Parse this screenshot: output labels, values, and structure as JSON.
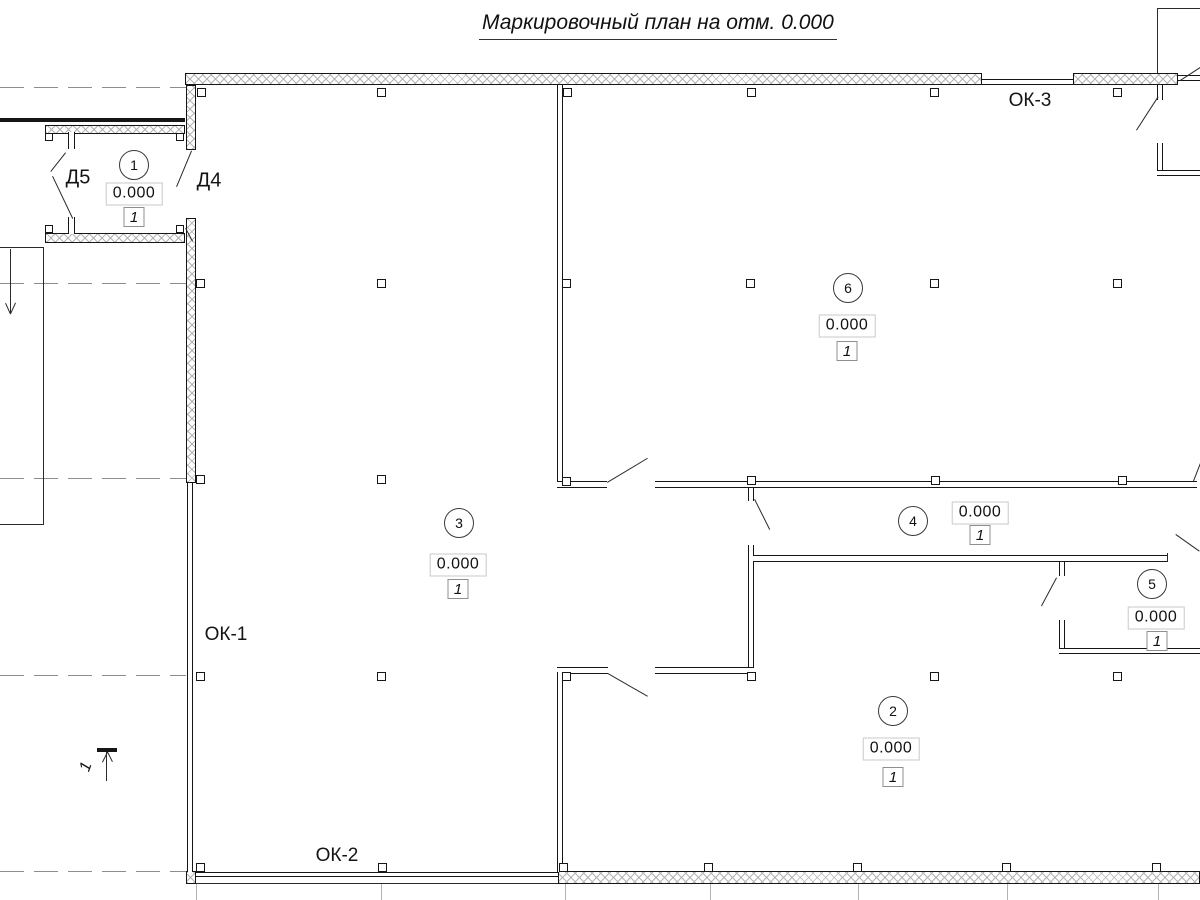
{
  "title": "Маркировочный план на отм. 0.000",
  "labels": {
    "ok1": {
      "text": "ОК-1"
    },
    "ok2": {
      "text": "ОК-2"
    },
    "ok3": {
      "text": "ОК-3"
    },
    "d5": {
      "text": "Д5"
    },
    "d4": {
      "text": "Д4"
    },
    "section": {
      "text": "1"
    }
  },
  "rooms": [
    {
      "number": "1",
      "elevation": "0.000",
      "finish": "1",
      "circle": [
        134,
        165
      ],
      "elev_pos": [
        134,
        194
      ],
      "fin_pos": [
        134,
        217
      ]
    },
    {
      "number": "6",
      "elevation": "0.000",
      "finish": "1",
      "circle": [
        848,
        288
      ],
      "elev_pos": [
        847,
        326
      ],
      "fin_pos": [
        847,
        351
      ]
    },
    {
      "number": "3",
      "elevation": "0.000",
      "finish": "1",
      "circle": [
        459,
        523
      ],
      "elev_pos": [
        458,
        565
      ],
      "fin_pos": [
        458,
        589
      ]
    },
    {
      "number": "4",
      "elevation": "0.000",
      "finish": "1",
      "circle": [
        913,
        521
      ],
      "elev_pos": [
        980,
        513
      ],
      "fin_pos": [
        980,
        535
      ]
    },
    {
      "number": "5",
      "elevation": "0.000",
      "finish": "1",
      "circle": [
        1152,
        584
      ],
      "elev_pos": [
        1156,
        618
      ],
      "fin_pos": [
        1157,
        641
      ]
    },
    {
      "number": "2",
      "elevation": "0.000",
      "finish": "1",
      "circle": [
        893,
        711
      ],
      "elev_pos": [
        891,
        749
      ],
      "fin_pos": [
        893,
        777
      ]
    }
  ],
  "colors": {
    "line": "#161616",
    "hatch": "#b4b4b4",
    "grid_dash": "#8d8d8d",
    "grid_light": "#b3b3b3",
    "elev_box_border": "#c9c9c9",
    "fin_box_border": "#8f8f8f"
  },
  "drawing": {
    "hatched_walls": [
      [
        185,
        73,
        797,
        12
      ],
      [
        1073,
        73,
        105,
        12
      ],
      [
        186,
        85,
        10,
        65
      ],
      [
        186,
        218,
        10,
        265
      ],
      [
        45,
        125,
        140,
        9
      ],
      [
        45,
        233,
        140,
        10
      ],
      [
        558,
        871,
        642,
        13
      ],
      [
        186,
        871,
        10,
        13
      ]
    ],
    "double_walls": [
      [
        557,
        85,
        6,
        397
      ],
      [
        557,
        481,
        50,
        7
      ],
      [
        655,
        481,
        542,
        7
      ],
      [
        748,
        545,
        6,
        128
      ],
      [
        753,
        555,
        415,
        7
      ],
      [
        655,
        667,
        99,
        7
      ],
      [
        557,
        667,
        51,
        7
      ],
      [
        557,
        672,
        6,
        200
      ],
      [
        1059,
        620,
        6,
        34
      ],
      [
        1059,
        648,
        141,
        6
      ],
      [
        1157,
        143,
        6,
        33
      ],
      [
        1157,
        170,
        43,
        6
      ],
      [
        187,
        483,
        6,
        389
      ],
      [
        982,
        79,
        91,
        6
      ],
      [
        1178,
        75,
        22,
        6
      ],
      [
        196,
        872,
        362,
        5
      ]
    ],
    "jamb_stubs": [
      [
        68,
        132,
        7,
        17
      ],
      [
        68,
        217,
        7,
        17
      ],
      [
        748,
        488,
        6,
        13
      ],
      [
        1059,
        562,
        6,
        14
      ],
      [
        1157,
        85,
        6,
        15
      ]
    ],
    "thick_lines": [
      [
        0,
        118,
        185,
        4
      ],
      [
        97,
        748,
        20,
        4
      ]
    ],
    "solid_lines": [
      [
        44,
        247,
        44,
        525
      ],
      [
        0,
        524,
        44,
        524
      ],
      [
        0,
        247,
        44,
        247
      ],
      [
        1158,
        8,
        1158,
        73
      ],
      [
        1158,
        8,
        1200,
        8
      ],
      [
        196,
        883,
        558,
        883
      ],
      [
        1168,
        553,
        1168,
        562
      ],
      [
        107,
        752,
        107,
        781
      ],
      [
        102,
        762,
        107,
        752
      ],
      [
        112,
        762,
        107,
        752
      ],
      [
        11,
        249,
        11,
        313
      ],
      [
        6,
        303,
        11,
        314
      ],
      [
        16,
        303,
        11,
        314
      ]
    ],
    "leader_lines": [
      [
        66,
        153,
        51,
        172
      ],
      [
        53,
        176,
        73,
        218
      ],
      [
        192,
        151,
        177,
        187
      ],
      [
        186,
        228,
        193,
        241
      ],
      [
        607,
        482,
        647,
        458
      ],
      [
        608,
        673,
        648,
        696
      ],
      [
        755,
        499,
        770,
        529
      ],
      [
        1057,
        578,
        1042,
        606
      ],
      [
        1176,
        534,
        1200,
        551
      ],
      [
        1193,
        481,
        1200,
        463
      ],
      [
        1136,
        130,
        1158,
        96
      ],
      [
        1180,
        80,
        1200,
        67
      ]
    ],
    "dashed_gridlines": [
      [
        0,
        87,
        186
      ],
      [
        0,
        283,
        186
      ],
      [
        0,
        478,
        186
      ],
      [
        0,
        675,
        186
      ],
      [
        0,
        871,
        186
      ]
    ],
    "grid_ticks_vertical": [
      [
        196,
        884,
        900
      ],
      [
        381,
        884,
        900
      ],
      [
        565,
        884,
        900
      ],
      [
        710,
        884,
        900
      ],
      [
        858,
        884,
        900
      ],
      [
        1007,
        884,
        900
      ],
      [
        1158,
        884,
        900
      ]
    ],
    "column_markers": [
      [
        201,
        92
      ],
      [
        381,
        92
      ],
      [
        567,
        92
      ],
      [
        751,
        92
      ],
      [
        934,
        92
      ],
      [
        1117,
        92
      ],
      [
        200,
        283
      ],
      [
        381,
        283
      ],
      [
        566,
        283
      ],
      [
        750,
        283
      ],
      [
        934,
        283
      ],
      [
        1117,
        283
      ],
      [
        200,
        479
      ],
      [
        381,
        479
      ],
      [
        566,
        481
      ],
      [
        751,
        480
      ],
      [
        935,
        480
      ],
      [
        1122,
        480
      ],
      [
        200,
        676
      ],
      [
        381,
        676
      ],
      [
        566,
        676
      ],
      [
        751,
        676
      ],
      [
        934,
        676
      ],
      [
        1117,
        676
      ],
      [
        200,
        867
      ],
      [
        382,
        867
      ],
      [
        563,
        867
      ],
      [
        708,
        867
      ],
      [
        857,
        867
      ],
      [
        1006,
        867
      ],
      [
        1156,
        867
      ]
    ],
    "wall_hooks": [
      [
        49,
        137
      ],
      [
        180,
        137
      ],
      [
        49,
        229
      ],
      [
        180,
        229
      ]
    ]
  }
}
